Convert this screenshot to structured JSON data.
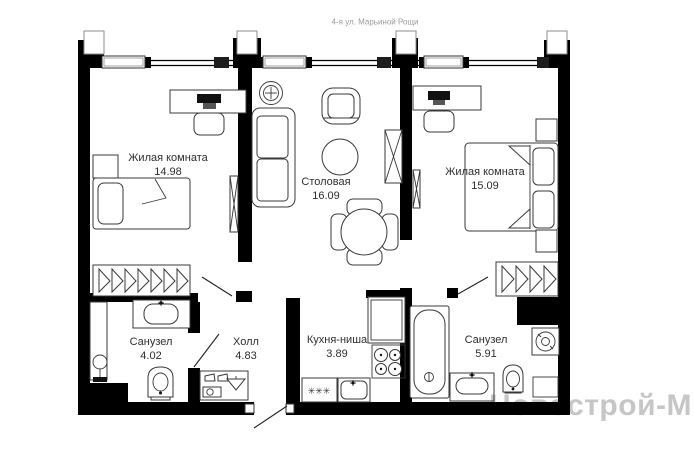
{
  "header": {
    "address": "4-я ул. Марьиной Рощи"
  },
  "watermark": {
    "text": "Новострой-М"
  },
  "rooms": [
    {
      "id": "living-1",
      "name": "Жилая комната",
      "area": "14.98"
    },
    {
      "id": "dining",
      "name": "Столовая",
      "area": "16.09"
    },
    {
      "id": "living-2",
      "name": "Жилая комната",
      "area": "15.09"
    },
    {
      "id": "bathroom-1",
      "name": "Санузел",
      "area": "4.02"
    },
    {
      "id": "hall",
      "name": "Холл",
      "area": "4.83"
    },
    {
      "id": "kitchen",
      "name": "Кухня-ниша",
      "area": "3.89"
    },
    {
      "id": "bathroom-2",
      "name": "Санузел",
      "area": "5.91"
    }
  ],
  "icons": {
    "kitchen_unit_symbol": "✳✳✳"
  },
  "colors": {
    "wall": "#000000",
    "furniture_line": "#383838",
    "watermark": "#c6c6c6",
    "header_text": "#9a9a9a",
    "label_text": "#2e2e2e"
  }
}
